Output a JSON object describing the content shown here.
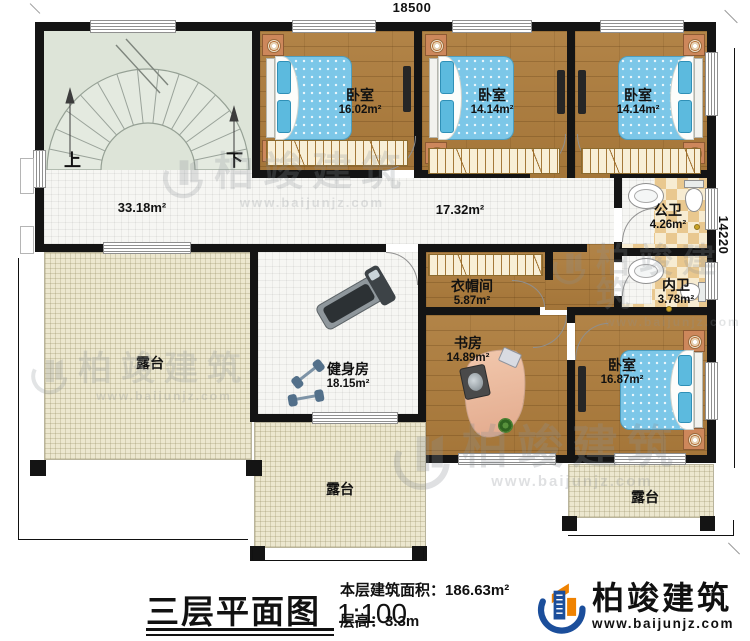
{
  "dimensions": {
    "width_mm": "18500",
    "depth_mm": "14220"
  },
  "stairs": {
    "up": "上",
    "down": "下"
  },
  "areas": {
    "hall": "33.18m²",
    "corridor": "17.32m²"
  },
  "rooms": {
    "bedroom1": {
      "name": "卧室",
      "area": "16.02m²"
    },
    "bedroom2": {
      "name": "卧室",
      "area": "14.14m²"
    },
    "bedroom3": {
      "name": "卧室",
      "area": "14.14m²"
    },
    "public_bath": {
      "name": "公卫",
      "area": "4.26m²"
    },
    "inner_bath": {
      "name": "内卫",
      "area": "3.78m²"
    },
    "cloakroom": {
      "name": "衣帽间",
      "area": "5.87m²"
    },
    "study": {
      "name": "书房",
      "area": "14.89m²"
    },
    "bedroom4": {
      "name": "卧室",
      "area": "16.87m²"
    },
    "gym": {
      "name": "健身房",
      "area": "18.15m²"
    },
    "terrace_left": {
      "name": "露台"
    },
    "terrace_bottom": {
      "name": "露台"
    },
    "terrace_right": {
      "name": "露台"
    }
  },
  "footer": {
    "plan_title": "三层平面图",
    "scale": "1:100",
    "floor_area_label": "本层建筑面积：",
    "floor_area_value": "186.63m²",
    "floor_height_label": "层高：",
    "floor_height_value": "3.3m",
    "brand_name": "柏竣建筑",
    "brand_url": "www.baijunjz.com"
  },
  "watermark": {
    "brand": "柏竣建筑",
    "url": "www.baijunjz.com"
  },
  "colors": {
    "wall": "#141414",
    "wood": "#ad7c3c",
    "tile": "#f6f6f3",
    "terrace": "#ece7cf",
    "stair_room": "#dde4d8",
    "bath_checker_dark": "#e9c88f",
    "bath_checker_light": "#f7ecd2",
    "bed": "#7cc7e8",
    "brand_blue": "#1b4e9b",
    "brand_orange": "#ef8200"
  }
}
